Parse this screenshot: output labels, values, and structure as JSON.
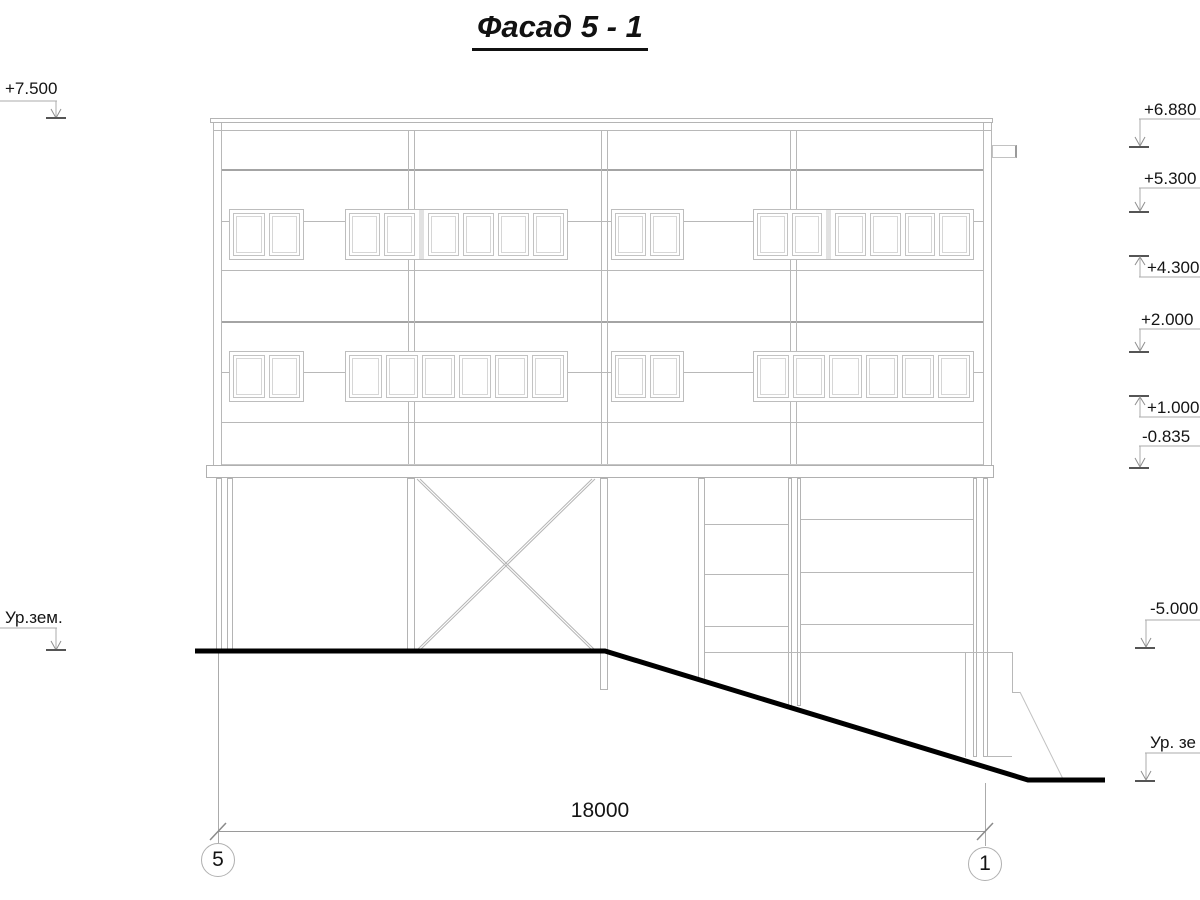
{
  "title": "Фасад 5 - 1",
  "markers": {
    "left": [
      {
        "label": "+7.500"
      },
      {
        "label": "Ур.зем."
      }
    ],
    "right": [
      {
        "label": "+6.880"
      },
      {
        "label": "+5.300"
      },
      {
        "label": "+4.300"
      },
      {
        "label": "+2.000"
      },
      {
        "label": "+1.000"
      },
      {
        "label": "-0.835"
      },
      {
        "label": "-5.000"
      },
      {
        "label": "Ур. зе"
      }
    ]
  },
  "dimension": {
    "value": "18000"
  },
  "grid_axes": [
    {
      "label": "5"
    },
    {
      "label": "1"
    }
  ],
  "colors": {
    "line": "#b8b8b8",
    "ground": "#000000",
    "text": "#141414"
  }
}
